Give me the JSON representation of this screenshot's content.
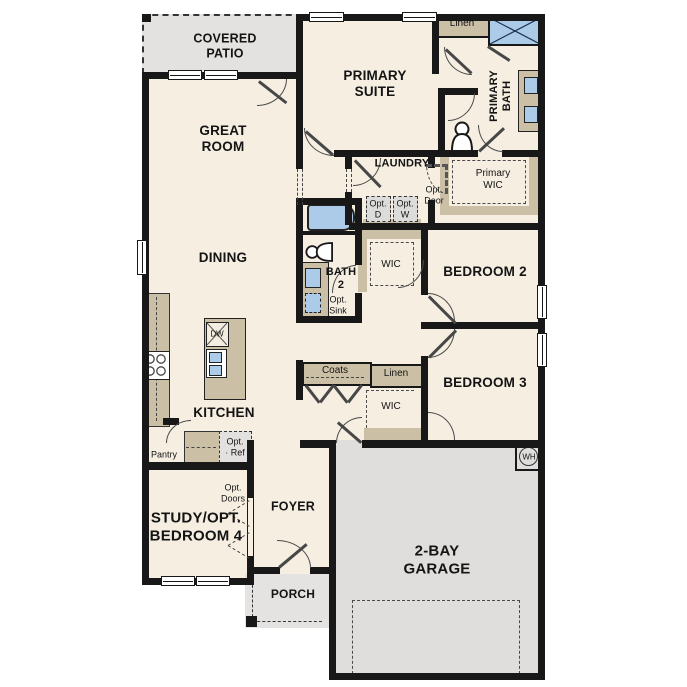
{
  "plan": {
    "rooms": {
      "covered_patio": "COVERED\nPATIO",
      "great_room": "GREAT\nROOM",
      "primary_suite": "PRIMARY\nSUITE",
      "primary_bath": "PRIMARY\nBATH",
      "primary_wic": "Primary\nWIC",
      "laundry": "LAUNDRY",
      "dining": "DINING",
      "bath_2": "BATH\n2",
      "bedroom_2": "BEDROOM 2",
      "bedroom_3": "BEDROOM 3",
      "kitchen": "KITCHEN",
      "study": "STUDY/OPT.\nBEDROOM 4",
      "foyer": "FOYER",
      "porch": "PORCH",
      "garage": "2-BAY\nGARAGE"
    },
    "closets": {
      "linen_primary": "Linen",
      "linen_hall": "Linen",
      "coats": "Coats",
      "wic_bed2": "WIC",
      "wic_bed3": "WIC",
      "pantry": "Pantry"
    },
    "options": {
      "opt_door": "Opt.\nDoor",
      "opt_dryer": "Opt.\nD",
      "opt_washer": "Opt.\nW",
      "opt_sink": "Opt.\nSink",
      "opt_ref": "Opt.\n· Ref",
      "opt_doors": "Opt.\nDoors"
    },
    "appliances": {
      "dishwasher": "DW",
      "water_heater": "WH"
    },
    "colors": {
      "floor": "#f5eee1",
      "patio_gray": "#e3e2e0",
      "garage_gray": "#dfdedc",
      "cabinet_tan": "#cbbfa6",
      "fixture_blue": "#abcbe9",
      "wall": "#181818"
    }
  }
}
